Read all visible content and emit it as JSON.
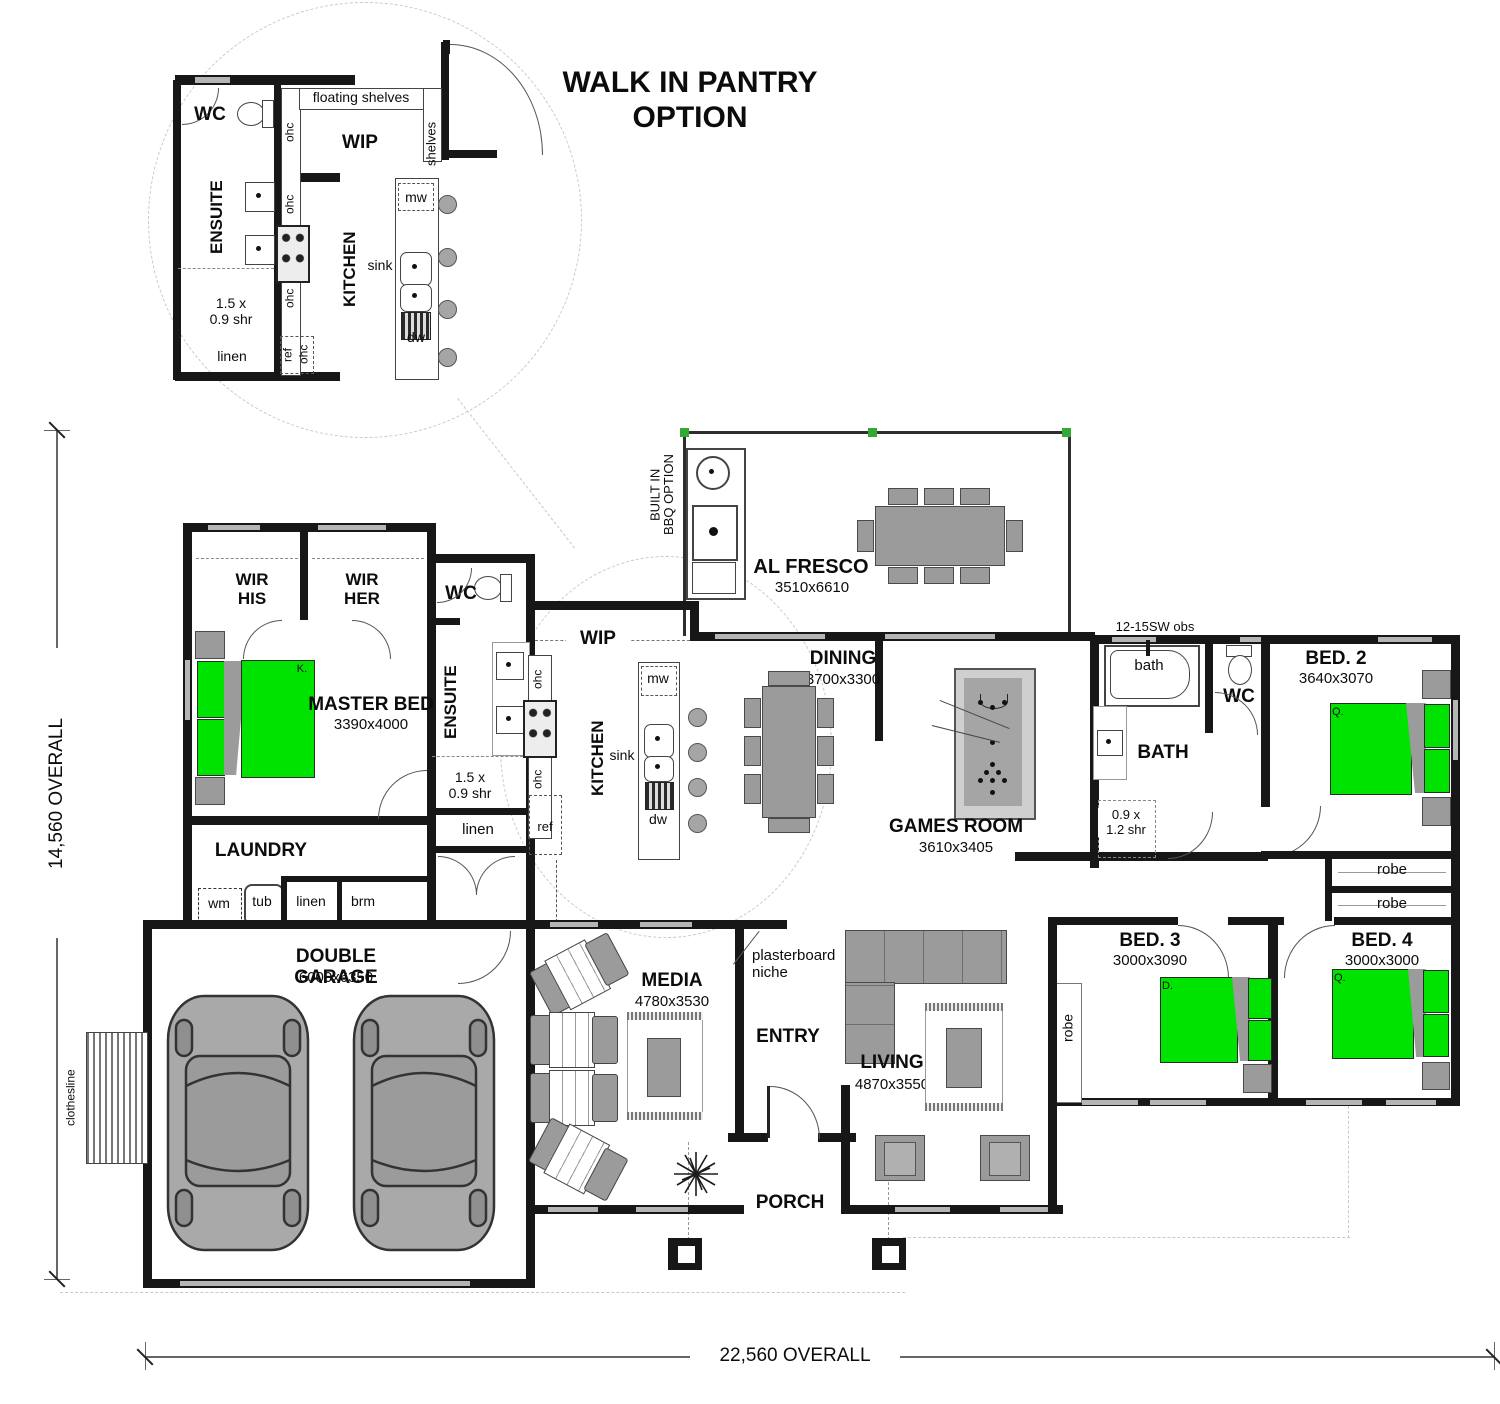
{
  "title": "WALK IN PANTRY\nOPTION",
  "overall": {
    "width_label": "22,560 OVERALL",
    "height_label": "14,560 OVERALL"
  },
  "colors": {
    "wall": "#171717",
    "bed_green": "#00e300",
    "furniture_gray": "#9b9b9b",
    "window_gray": "#b5b5b5",
    "al_fresco_post_green": "#33aa33"
  },
  "inset": {
    "wc": "WC",
    "floating_shelves": "floating shelves",
    "wip": "WIP",
    "shelves": "shelves",
    "ensuite": "ENSUITE",
    "kitchen": "KITCHEN",
    "ohc_top": "ohc",
    "ohc_mid": "ohc",
    "ohc_low": "ohc",
    "ohc_ref": "ohc",
    "ref": "ref",
    "mw": "mw",
    "sink": "sink",
    "dw": "dw",
    "shower": "1.5 x\n0.9 shr",
    "linen": "linen"
  },
  "main": {
    "wir_his": "WIR\nHIS",
    "wir_her": "WIR\nHER",
    "wc1": "WC",
    "master_name": "MASTER BED",
    "master_size": "3390x4000",
    "master_bed_tag": "K.",
    "ensuite": "ENSUITE",
    "ensuite_shower": "1.5 x\n0.9 shr",
    "ensuite_linen": "linen",
    "ohc_top": "ohc",
    "ohc_low": "ohc",
    "ref": "ref",
    "wip": "WIP",
    "kitchen": "KITCHEN",
    "mw": "mw",
    "sink": "sink",
    "dw": "dw",
    "laundry": "LAUNDRY",
    "wm": "wm",
    "tub": "tub",
    "laundry_linen": "linen",
    "brm": "brm",
    "garage_name": "DOUBLE GARAGE",
    "garage_size": "6000x6350",
    "clothesline": "clothesline",
    "media_name": "MEDIA",
    "media_size": "4780x3530",
    "niche": "plasterboard\nniche",
    "entry": "ENTRY",
    "porch": "PORCH",
    "living_name": "LIVING",
    "living_size": "4870x3550",
    "dining_name": "DINING",
    "dining_size": "3700x3300",
    "alfresco_name": "AL FRESCO",
    "alfresco_size": "3510x6610",
    "bbq": "BUILT IN\nBBQ OPTION",
    "games_name": "GAMES ROOM",
    "games_size": "3610x3405",
    "bath_name": "BATH",
    "bath_tub": "bath",
    "bath_shower": "0.9 x\n1.2 shr",
    "bath_window": "12-15SW obs",
    "wc2": "WC",
    "bed2_name": "BED. 2",
    "bed2_size": "3640x3070",
    "bed2_tag": "Q.",
    "robe_a": "robe",
    "robe_b": "robe",
    "bed3_name": "BED. 3",
    "bed3_size": "3000x3090",
    "bed3_tag": "D.",
    "bed3_robe": "robe",
    "bed4_name": "BED. 4",
    "bed4_size": "3000x3000",
    "bed4_tag": "Q."
  }
}
